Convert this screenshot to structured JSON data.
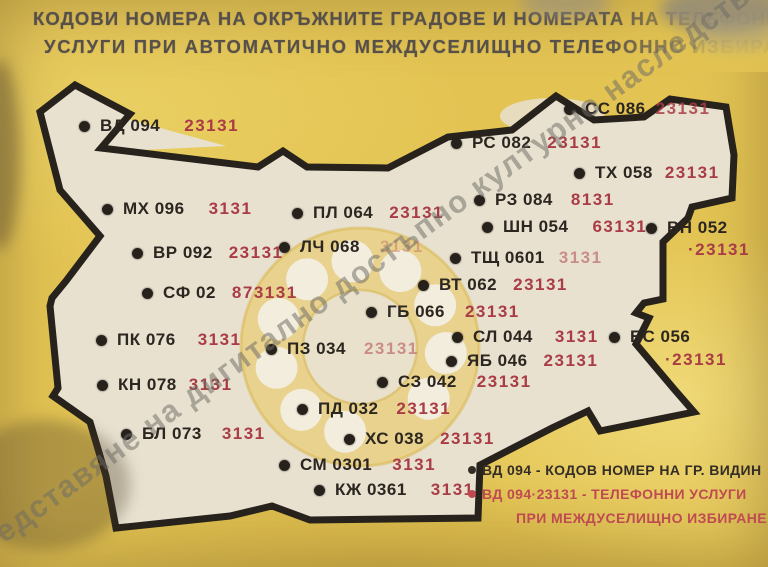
{
  "card": {
    "title_line1": "КОДОВИ НОМЕРА НА ОКРЪЖНИТЕ ГРАДОВЕ И НОМЕРАТА НА ТЕЛЕФОННИ",
    "title_line2": "УСЛУГИ ПРИ АВТОМАТИЧНО МЕЖДУСЕЛИЩНО ТЕЛЕФОННО ИЗБИРАНЕ",
    "watermark": "представяне на дигитално достъпно културно наследство"
  },
  "colors": {
    "background_yellow": "#e3c453",
    "map_paper": "#e8e1d0",
    "map_border": "#27221b",
    "code_text": "#2b2620",
    "service_red": "#a93c45",
    "legend_red": "#bf4a52",
    "title_ink": "#57504a"
  },
  "map": {
    "cities": [
      {
        "code": "ВД 094",
        "service": "23131",
        "x": 85,
        "y": 126,
        "gap": 24
      },
      {
        "code": "СС 086",
        "service": "23131",
        "x": 570,
        "y": 109,
        "gap": 10,
        "fade": 0.85
      },
      {
        "code": "РС 082",
        "service": "23131",
        "x": 457,
        "y": 143,
        "gap": 16
      },
      {
        "code": "ТХ 058",
        "service": "23131",
        "x": 580,
        "y": 173,
        "gap": 12
      },
      {
        "code": "МХ 096",
        "service": "3131",
        "x": 108,
        "y": 209,
        "gap": 24
      },
      {
        "code": "ПЛ 064",
        "service": "23131",
        "x": 298,
        "y": 213,
        "gap": 16
      },
      {
        "code": "РЗ 084",
        "service": "8131",
        "x": 480,
        "y": 200,
        "gap": 18
      },
      {
        "code": "ШН 054",
        "service": "63131",
        "x": 488,
        "y": 227,
        "gap": 24
      },
      {
        "code": "ВН 052",
        "service": "23131",
        "x": 652,
        "y": 228,
        "below": true,
        "prefix": "·",
        "sdx": 42,
        "sdy": 23
      },
      {
        "code": "ВР 092",
        "service": "23131",
        "x": 138,
        "y": 253,
        "gap": 16
      },
      {
        "code": "ЛЧ 068",
        "service": "3131",
        "x": 285,
        "y": 247,
        "gap": 20,
        "fade": 0.3
      },
      {
        "code": "ТЩ 0601",
        "service": "3131",
        "x": 456,
        "y": 258,
        "gap": 14,
        "fade": 0.5
      },
      {
        "code": "СФ 02",
        "service": "873131",
        "x": 148,
        "y": 293,
        "gap": 16
      },
      {
        "code": "ВТ 062",
        "service": "23131",
        "x": 424,
        "y": 285,
        "gap": 16
      },
      {
        "code": "ГБ 066",
        "service": "23131",
        "x": 372,
        "y": 312,
        "gap": 20
      },
      {
        "code": "ПК 076",
        "service": "3131",
        "x": 102,
        "y": 340,
        "gap": 22
      },
      {
        "code": "ПЗ 034",
        "service": "23131",
        "x": 272,
        "y": 349,
        "gap": 18,
        "fade": 0.5
      },
      {
        "code": "СЛ 044",
        "service": "3131",
        "x": 458,
        "y": 337,
        "gap": 22
      },
      {
        "code": "ЯБ 046",
        "service": "23131",
        "x": 452,
        "y": 361,
        "gap": 16
      },
      {
        "code": "БС 056",
        "service": "23131",
        "x": 615,
        "y": 337,
        "below": true,
        "prefix": "·",
        "sdx": 56,
        "sdy": 24
      },
      {
        "code": "КН 078",
        "service": "3131",
        "x": 103,
        "y": 385,
        "gap": 12
      },
      {
        "code": "СЗ 042",
        "service": "23131",
        "x": 383,
        "y": 382,
        "gap": 20
      },
      {
        "code": "ПД 032",
        "service": "23131",
        "x": 303,
        "y": 409,
        "gap": 18
      },
      {
        "code": "БЛ 073",
        "service": "3131",
        "x": 127,
        "y": 434,
        "gap": 20
      },
      {
        "code": "ХС 038",
        "service": "23131",
        "x": 350,
        "y": 439,
        "gap": 16
      },
      {
        "code": "СМ 0301",
        "service": "3131",
        "x": 285,
        "y": 465,
        "gap": 20
      },
      {
        "code": "КЖ 0361",
        "service": "3131",
        "x": 320,
        "y": 490,
        "gap": 24
      }
    ]
  },
  "legend": {
    "line1": "ВД 094 - КОДОВ НОМЕР НА ГР. ВИДИН",
    "line2": "ВД 094·23131 - ТЕЛЕФОННИ УСЛУГИ",
    "line3": "ПРИ МЕЖДУСЕЛИЩНО ИЗБИРАНЕ"
  }
}
